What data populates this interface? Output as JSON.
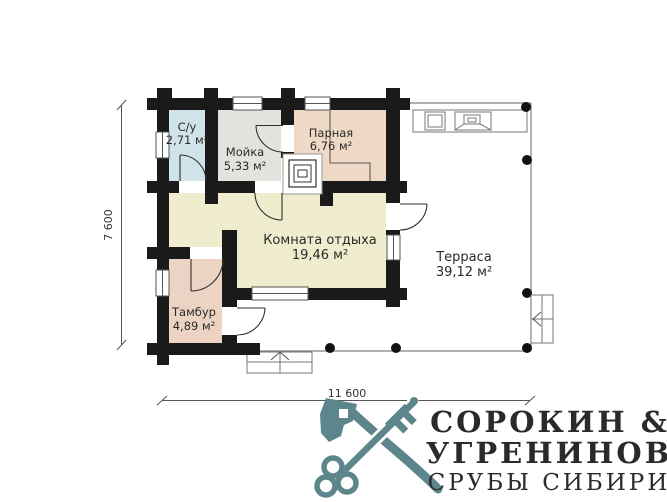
{
  "plan": {
    "dim_width_label": "11 600",
    "dim_height_label": "7 600",
    "wall_color": "#1a1a1a",
    "rooms": [
      {
        "name": "С/у",
        "area": "2,71 м²",
        "color": "#cfe3e8"
      },
      {
        "name": "Мойка",
        "area": "5,33 м²",
        "color": "#e3e3de"
      },
      {
        "name": "Парная",
        "area": "6,76 м²",
        "color": "#eed9c6"
      },
      {
        "name": "Комната отдыха",
        "area": "19,46 м²",
        "color": "#f0ecce"
      },
      {
        "name": "Тамбур",
        "area": "4,89 м²",
        "color": "#edd3c3"
      },
      {
        "name": "Терраса",
        "area": "39,12 м²",
        "color": "#ffffff"
      }
    ]
  },
  "logo": {
    "line1": "СОРОКИН &",
    "line2": "УГРЕНИНОВ",
    "line3": "СРУБЫ СИБИРИ",
    "color": "#5d868c"
  }
}
